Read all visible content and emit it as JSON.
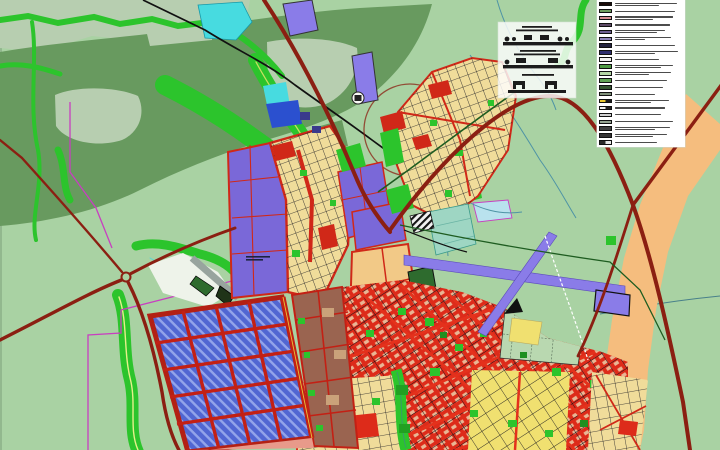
{
  "map": {
    "kind": "city-master-plan-map",
    "purple_district_note": {
      "text_lines": 2
    },
    "palette": {
      "bg": "#a9d2a3",
      "terrain_dark": "#689a5f",
      "terrain_pale": "#b7ceb0",
      "vegetation": "#2cc42c",
      "water_cyan": "#47dbe0",
      "water_blue": "#2b50cf",
      "road_major": "#8b1f12",
      "road_city": "#d02818",
      "district_tan": "#f0dc9a",
      "district_purple": "#7a68d8",
      "district_blue": "#5166d2",
      "district_brown": "#9a6450",
      "district_red": "#dd2b1a",
      "district_yellow": "#f0e070",
      "district_sage": "#b9d8b0",
      "district_orange": "#f5bd7e",
      "runway_purple": "#8a7ce8",
      "boundary_magenta": "#c83fc0",
      "legend_bg": "#ffffff"
    }
  },
  "legend": {
    "entries": [
      {
        "colors": [
          "#1a0b08"
        ],
        "widths": [
          62,
          44
        ]
      },
      {
        "colors": [
          "#6f9e5e"
        ],
        "widths": [
          60
        ]
      },
      {
        "colors": [
          "#d68b90"
        ],
        "widths": [
          58,
          38
        ]
      },
      {
        "colors": [
          "#5d4a66"
        ],
        "widths": [
          55
        ]
      },
      {
        "colors": [
          "#6d5d8f"
        ],
        "widths": [
          50,
          42
        ]
      },
      {
        "colors": [
          "#8d82b8"
        ],
        "widths": [
          56,
          30
        ]
      },
      {
        "colors": [
          "#23233f"
        ],
        "widths": [
          60
        ]
      },
      {
        "colors": [
          "#2e2e6e"
        ],
        "widths": [
          63,
          40
        ]
      },
      {
        "colors": [
          "#f2f2f2"
        ],
        "widths": [
          44
        ]
      },
      {
        "colors": [
          "#4e9a44"
        ],
        "widths": [
          58,
          46
        ]
      },
      {
        "colors": [
          "#b5d6a5"
        ],
        "widths": [
          56,
          34
        ]
      },
      {
        "colors": [
          "#61a254"
        ],
        "widths": [
          52
        ]
      },
      {
        "colors": [
          "#35552f"
        ],
        "widths": [
          48
        ]
      },
      {
        "colors": [
          "#7e8f78"
        ],
        "widths": [
          40
        ]
      },
      {
        "colors": [
          "#e8c832",
          "#1a1a1a"
        ],
        "widths": [
          54,
          36
        ]
      },
      {
        "colors": [
          "#f0f0f0",
          "#222222"
        ],
        "widths": [
          50
        ]
      },
      {
        "colors": [
          "#cfcfcf"
        ],
        "widths": [
          46
        ]
      },
      {
        "colors": [
          "#95a391"
        ],
        "widths": [
          58
        ]
      },
      {
        "colors": [
          "#3f3f3f"
        ],
        "widths": [
          55,
          40
        ]
      },
      {
        "colors": [
          "#333333"
        ],
        "widths": [
          52,
          38
        ]
      },
      {
        "colors": [
          "#2b2b2b",
          "#e8e8e8"
        ],
        "widths": [
          42
        ]
      }
    ]
  },
  "cross_sections": {
    "sections": [
      {
        "caption_lines": 2
      },
      {
        "caption_lines": 2
      },
      {
        "caption_lines": 1
      }
    ]
  }
}
